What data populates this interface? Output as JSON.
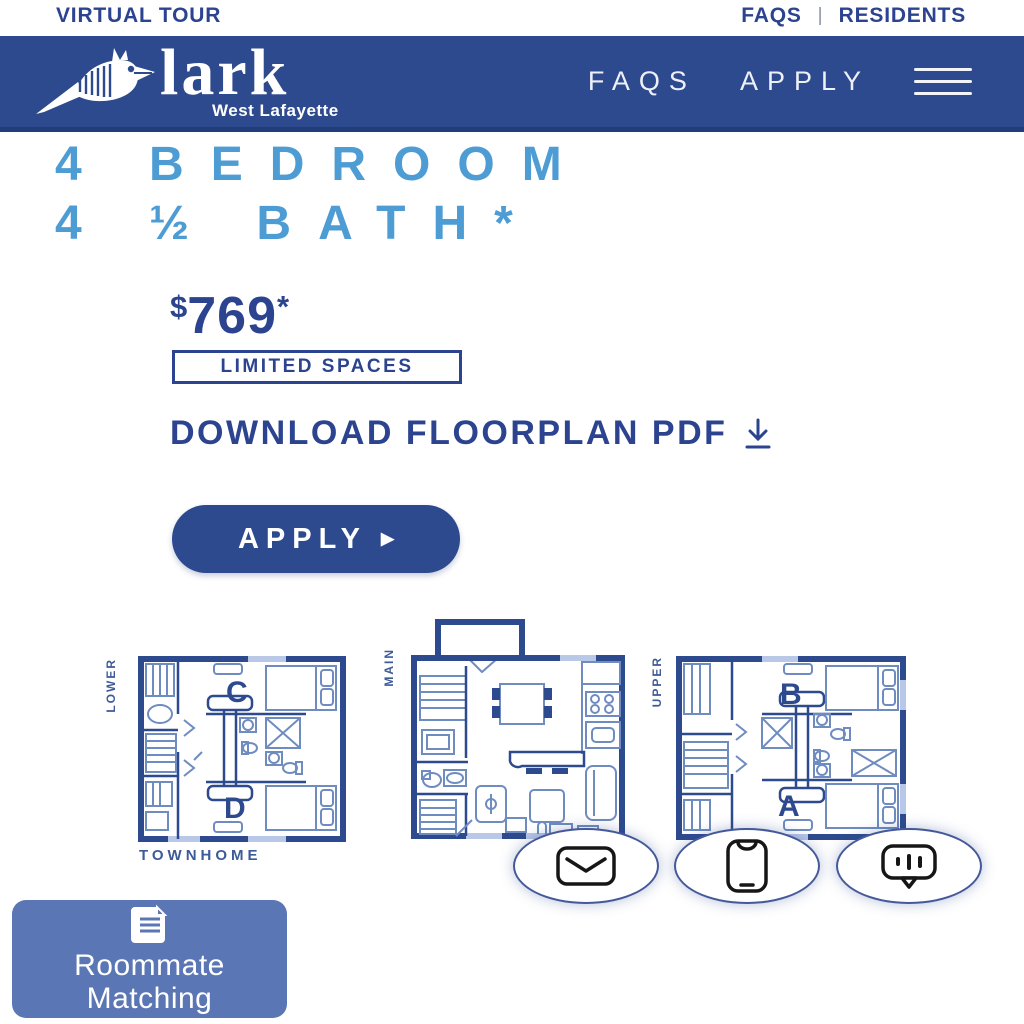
{
  "colors": {
    "navy_header": "#2e4a8e",
    "dark_navy_text": "#2c4390",
    "light_blue_heading": "#4e9cd4",
    "roommate_button": "#5b76b4",
    "plan_wall": "#2e4a8e",
    "plan_furniture": "#6f8cc0",
    "plan_window": "#b9c8e6"
  },
  "topbar": {
    "virtual_tour": "VIRTUAL TOUR",
    "faqs": "FAQS",
    "divider": "|",
    "residents": "RESIDENTS"
  },
  "header": {
    "brand": "lark",
    "brand_sub": "West Lafayette",
    "nav_faqs": "FAQS",
    "nav_apply": "APPLY",
    "menu_icon": "hamburger-icon"
  },
  "hero": {
    "title_line1": "4 BEDROOM",
    "title_line2": "4 ½ BATH*",
    "price_currency": "$",
    "price_value": "769",
    "price_asterisk": "*",
    "badge": "LIMITED SPACES",
    "download_label": "DOWNLOAD FLOORPLAN PDF",
    "download_icon": "download-icon",
    "apply_label": "APPLY",
    "apply_arrow": "▶"
  },
  "floorplans": {
    "lower_label": "LOWER",
    "main_label": "MAIN",
    "upper_label": "UPPER",
    "townhome_caption": "TOWNHOME",
    "rooms": {
      "c": "C",
      "d": "D",
      "b": "B",
      "a": "A"
    }
  },
  "contact_buttons": [
    {
      "icon": "envelope-icon"
    },
    {
      "icon": "phone-icon"
    },
    {
      "icon": "chat-bubble-icon"
    }
  ],
  "roommate": {
    "icon": "document-icon",
    "line1": "Roommate",
    "line2": "Matching"
  }
}
